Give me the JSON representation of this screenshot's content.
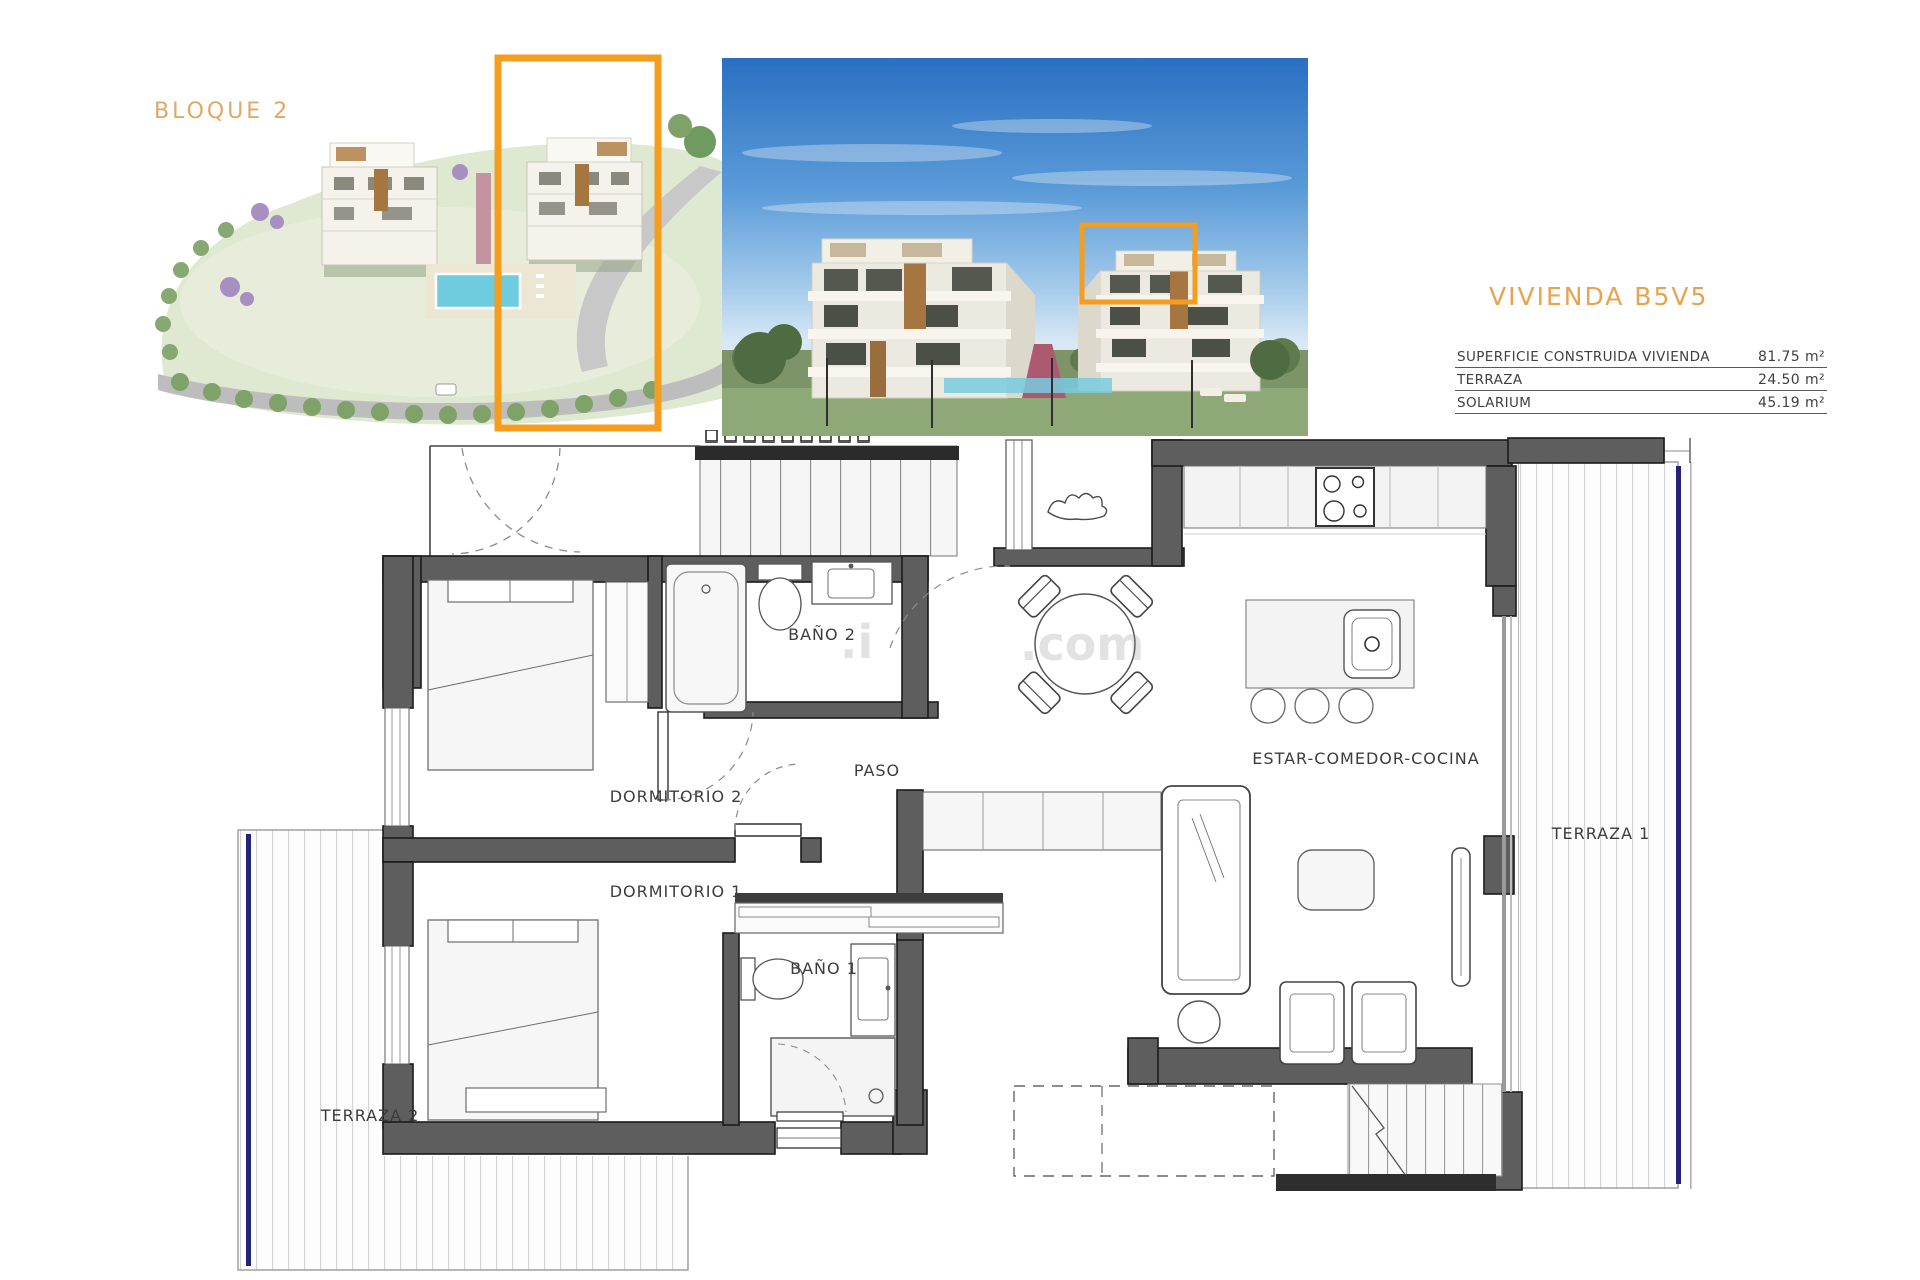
{
  "aerial": {
    "label": "BLOQUE 2",
    "label_color": "#dfa865",
    "highlight_color": "#f59d1e"
  },
  "photo": {
    "highlight_color": "#f59d1e"
  },
  "unit": {
    "title": "VIVIENDA B5V5",
    "title_color": "#e8a34e",
    "rows": [
      {
        "label": "SUPERFICIE CONSTRUIDA VIVIENDA",
        "value": "81.75 m²"
      },
      {
        "label": "TERRAZA",
        "value": "24.50 m²"
      },
      {
        "label": "SOLARIUM",
        "value": "45.19 m²"
      }
    ]
  },
  "plan": {
    "rooms": {
      "bano2": "BAÑO 2",
      "dormitorio2": "DORMITORIO 2",
      "paso": "PASO",
      "dormitorio1": "DORMITORIO 1",
      "bano1": "BAÑO 1",
      "estar": "ESTAR-COMEDOR-COCINA",
      "terraza1": "TERRAZA 1",
      "terraza2": "TERRAZA 2"
    },
    "colors": {
      "wall": "#5e5e5e",
      "railing": "#23237a"
    }
  },
  "watermark": {
    "fragments": [
      ".i",
      ".com"
    ]
  }
}
